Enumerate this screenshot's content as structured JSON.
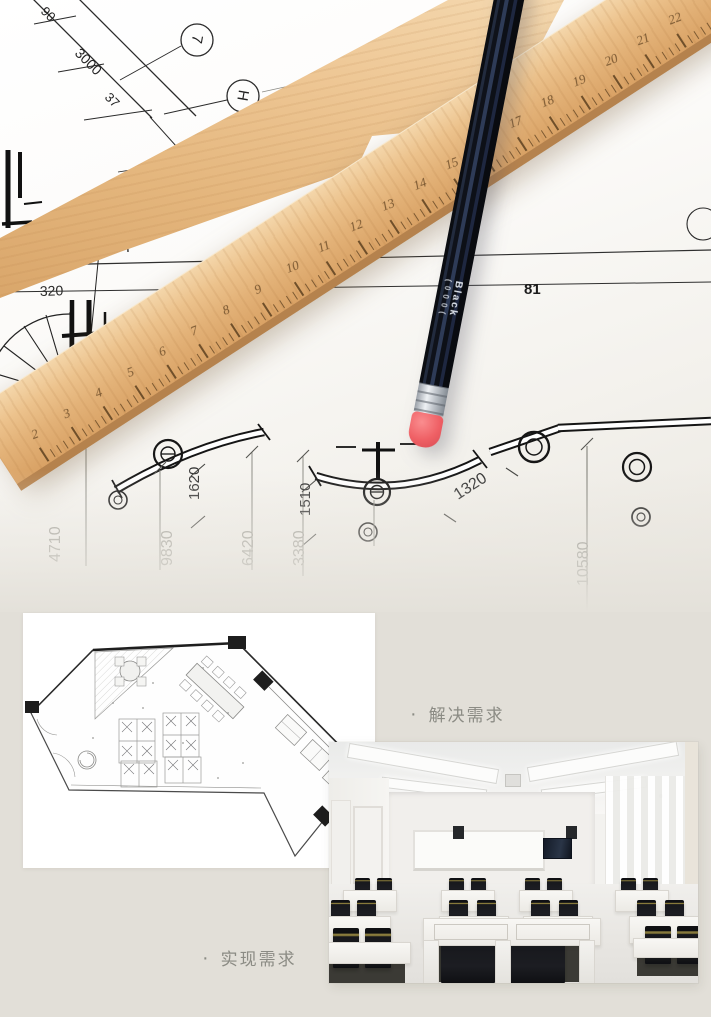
{
  "annotations": {
    "solve": {
      "bullet": "·",
      "label": "解决需求"
    },
    "realize": {
      "bullet": "·",
      "label": "实现需求"
    }
  },
  "blueprint": {
    "dims": {
      "d90": "90",
      "d3000": "3000",
      "d37": "37",
      "d320": "320",
      "d81": "81",
      "d1620": "1620",
      "d1510": "1510",
      "d1320": "1320",
      "d4710": "4710",
      "d9830": "9830",
      "d6420": "6420",
      "d3380": "3380",
      "d10580": "10580"
    },
    "markers": {
      "m1": "7",
      "m2": "H"
    }
  },
  "ruler": {
    "numbers": [
      "2",
      "3",
      "4",
      "5",
      "6",
      "7",
      "8",
      "9",
      "10",
      "11",
      "12",
      "13",
      "14",
      "15",
      "16",
      "17",
      "18",
      "19",
      "20",
      "21",
      "22"
    ]
  },
  "pencil": {
    "brand_text": "Black",
    "grade_text": "( 0 0 0 ("
  },
  "colors": {
    "lower_background": "#e2dfd8",
    "card_background": "#ffffff",
    "caption_text": "#8b8b84",
    "wood_light": "#f0d2a6",
    "wood_dark": "#c79058",
    "pencil_body": "#141822",
    "pencil_ferrule": "#d7dade",
    "pencil_eraser": "#f2686c",
    "blueprint_ink": "#1f1f1f",
    "dim_label_grey": "#a2a19a"
  }
}
